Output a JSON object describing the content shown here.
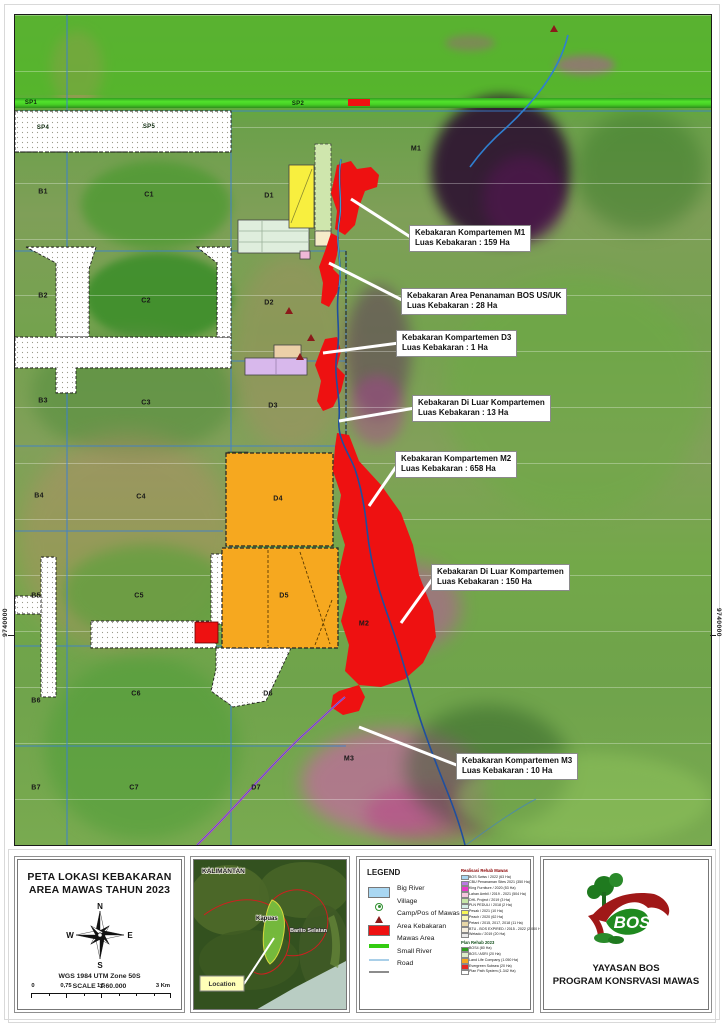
{
  "map": {
    "edge_coordinate_left": "9740000",
    "edge_coordinate_right": "9740000",
    "labels": [
      {
        "t": "SP1",
        "x": 16,
        "y": 88,
        "sp": true
      },
      {
        "t": "SP2",
        "x": 283,
        "y": 89,
        "sp": true
      },
      {
        "t": "SP4",
        "x": 28,
        "y": 113,
        "sp": true
      },
      {
        "t": "SP5",
        "x": 134,
        "y": 112,
        "sp": true
      },
      {
        "t": "B1",
        "x": 28,
        "y": 177
      },
      {
        "t": "B2",
        "x": 28,
        "y": 281
      },
      {
        "t": "B3",
        "x": 28,
        "y": 386
      },
      {
        "t": "B4",
        "x": 24,
        "y": 481
      },
      {
        "t": "B5",
        "x": 21,
        "y": 581
      },
      {
        "t": "B6",
        "x": 21,
        "y": 686
      },
      {
        "t": "B7",
        "x": 21,
        "y": 773
      },
      {
        "t": "C1",
        "x": 134,
        "y": 180
      },
      {
        "t": "C2",
        "x": 131,
        "y": 286
      },
      {
        "t": "C3",
        "x": 131,
        "y": 388
      },
      {
        "t": "C4",
        "x": 126,
        "y": 482
      },
      {
        "t": "C5",
        "x": 124,
        "y": 581
      },
      {
        "t": "C6",
        "x": 121,
        "y": 679
      },
      {
        "t": "C7",
        "x": 119,
        "y": 773
      },
      {
        "t": "D1",
        "x": 254,
        "y": 181
      },
      {
        "t": "D2",
        "x": 254,
        "y": 288
      },
      {
        "t": "D3",
        "x": 258,
        "y": 391
      },
      {
        "t": "D4",
        "x": 263,
        "y": 484
      },
      {
        "t": "D5",
        "x": 269,
        "y": 581
      },
      {
        "t": "D6",
        "x": 253,
        "y": 679
      },
      {
        "t": "D7",
        "x": 241,
        "y": 773
      },
      {
        "t": "M1",
        "x": 401,
        "y": 134
      },
      {
        "t": "M2",
        "x": 349,
        "y": 609
      },
      {
        "t": "M3",
        "x": 334,
        "y": 744
      }
    ],
    "callouts": [
      {
        "line1": "Kebakaran Kompartemen M1",
        "line2": "Luas Kebakaran : 159 Ha",
        "x": 394,
        "y": 210,
        "tx": 336,
        "ty": 184
      },
      {
        "line1": "Kebakaran Area Penanaman BOS US/UK",
        "line2": "Luas Kebakaran : 28 Ha",
        "x": 386,
        "y": 273,
        "tx": 314,
        "ty": 248
      },
      {
        "line1": "Kebakaran Kompartemen D3",
        "line2": "Luas Kebakaran : 1 Ha",
        "x": 381,
        "y": 315,
        "tx": 308,
        "ty": 338
      },
      {
        "line1": "Kebakaran Di Luar Kompartemen",
        "line2": "Luas Kebakaran : 13 Ha",
        "x": 397,
        "y": 380,
        "tx": 324,
        "ty": 406
      },
      {
        "line1": "Kebakaran Kompartemen M2",
        "line2": "Luas Kebakaran : 658 Ha",
        "x": 380,
        "y": 436,
        "tx": 354,
        "ty": 491
      },
      {
        "line1": "Kebakaran Di Luar Kompartemen",
        "line2": "Luas Kebakaran : 150 Ha",
        "x": 416,
        "y": 549,
        "tx": 386,
        "ty": 608
      },
      {
        "line1": "Kebakaran Kompartemen M3",
        "line2": "Luas Kebakaran : 10 Ha",
        "x": 441,
        "y": 738,
        "tx": 344,
        "ty": 712
      }
    ]
  },
  "title_block": {
    "title_line1": "PETA LOKASI KEBAKARAN",
    "title_line2": "AREA MAWAS TAHUN 2023",
    "compass": {
      "n": "N",
      "e": "E",
      "s": "S",
      "w": "W"
    },
    "datum": "WGS 1984 UTM Zone 50S",
    "scale_label": "SCALE",
    "scale_value": "1:60.000",
    "scalebar_labels": [
      "0",
      "0,75",
      "1,5",
      "3 Km"
    ]
  },
  "inset": {
    "region": "KALIMANTAN",
    "label_kapuas": "Kapuas",
    "label_barito": "Barito Selatan",
    "location": "Location"
  },
  "legend": {
    "title": "LEGEND",
    "items": [
      {
        "label": "Big River",
        "type": "rect",
        "color": "#a9d7f2"
      },
      {
        "label": "Village",
        "type": "village",
        "color": "#2f8f2f"
      },
      {
        "label": "Camp/Pos of Mawas",
        "type": "triangle",
        "color": "#8b1a1a"
      },
      {
        "label": "Area Kebakaran",
        "type": "rect",
        "color": "#ee1111"
      },
      {
        "label": "Mawas Area",
        "type": "thickline",
        "color": "#33cc11"
      },
      {
        "label": "Small River",
        "type": "line",
        "color": "#a9cfe8"
      },
      {
        "label": "Road",
        "type": "line",
        "color": "#8c8c8c"
      }
    ],
    "rehab": {
      "title": "Realisasi Rehab Mawas",
      "title_color": "#8b0000",
      "items": [
        {
          "label": "BOS Swiss / 2022 (63 Ha)",
          "color": "#a9d7f2"
        },
        {
          "label": "CBU Penanaman Sites 2021 (350 Ha)",
          "color": "#b87ae0"
        },
        {
          "label": "King Furniture / 2020 (53 Ha)",
          "color": "#e838c8"
        },
        {
          "label": "Lahan Ambil / 2019 - 2021 (504 Ha)",
          "color": "#f6c6de"
        },
        {
          "label": "DHL Project / 2019 (3 Ha)",
          "color": "#c6e6a6"
        },
        {
          "label": "PLN PEDULI / 2018 (2 Ha)",
          "color": "#d6efe6"
        },
        {
          "label": "Pesak / 2021 (10 Ha)",
          "color": "#f6f655"
        },
        {
          "label": "Peach / 2020 (62 Ha)",
          "color": "#f8f6bb"
        },
        {
          "label": "Petani / 2015, 2017, 2018 (11 Ha)",
          "color": "#e7d7a7"
        },
        {
          "label": "BTU - BOS EXPIRED / 2015 - 2022 (2.000 Ha)",
          "color": "#f6efe0"
        },
        {
          "label": "Wetado / 2019 (20 Ha)",
          "color": "#e9e9e9"
        }
      ]
    },
    "plan": {
      "title": "Plan Rehab 2023",
      "title_color": "#14501c",
      "items": [
        {
          "label": "BOS4 (80 Ha)",
          "color": "#2f9e1f"
        },
        {
          "label": "BOS / ASRI (20 Ha)",
          "color": "#dcecc8"
        },
        {
          "label": "Land Life Company (1.050 Ha)",
          "color": "#f6a81f"
        },
        {
          "label": "Evergreen Subsea (20 Ha)",
          "color": "#e82820"
        },
        {
          "label": "Plan Path System (1.342 Ha)",
          "color": "#ffffff"
        }
      ]
    }
  },
  "logo": {
    "text": "BOS",
    "org_line1": "YAYASAN BOS",
    "org_line2": "PROGRAM KONSRVASI MAWAS"
  }
}
